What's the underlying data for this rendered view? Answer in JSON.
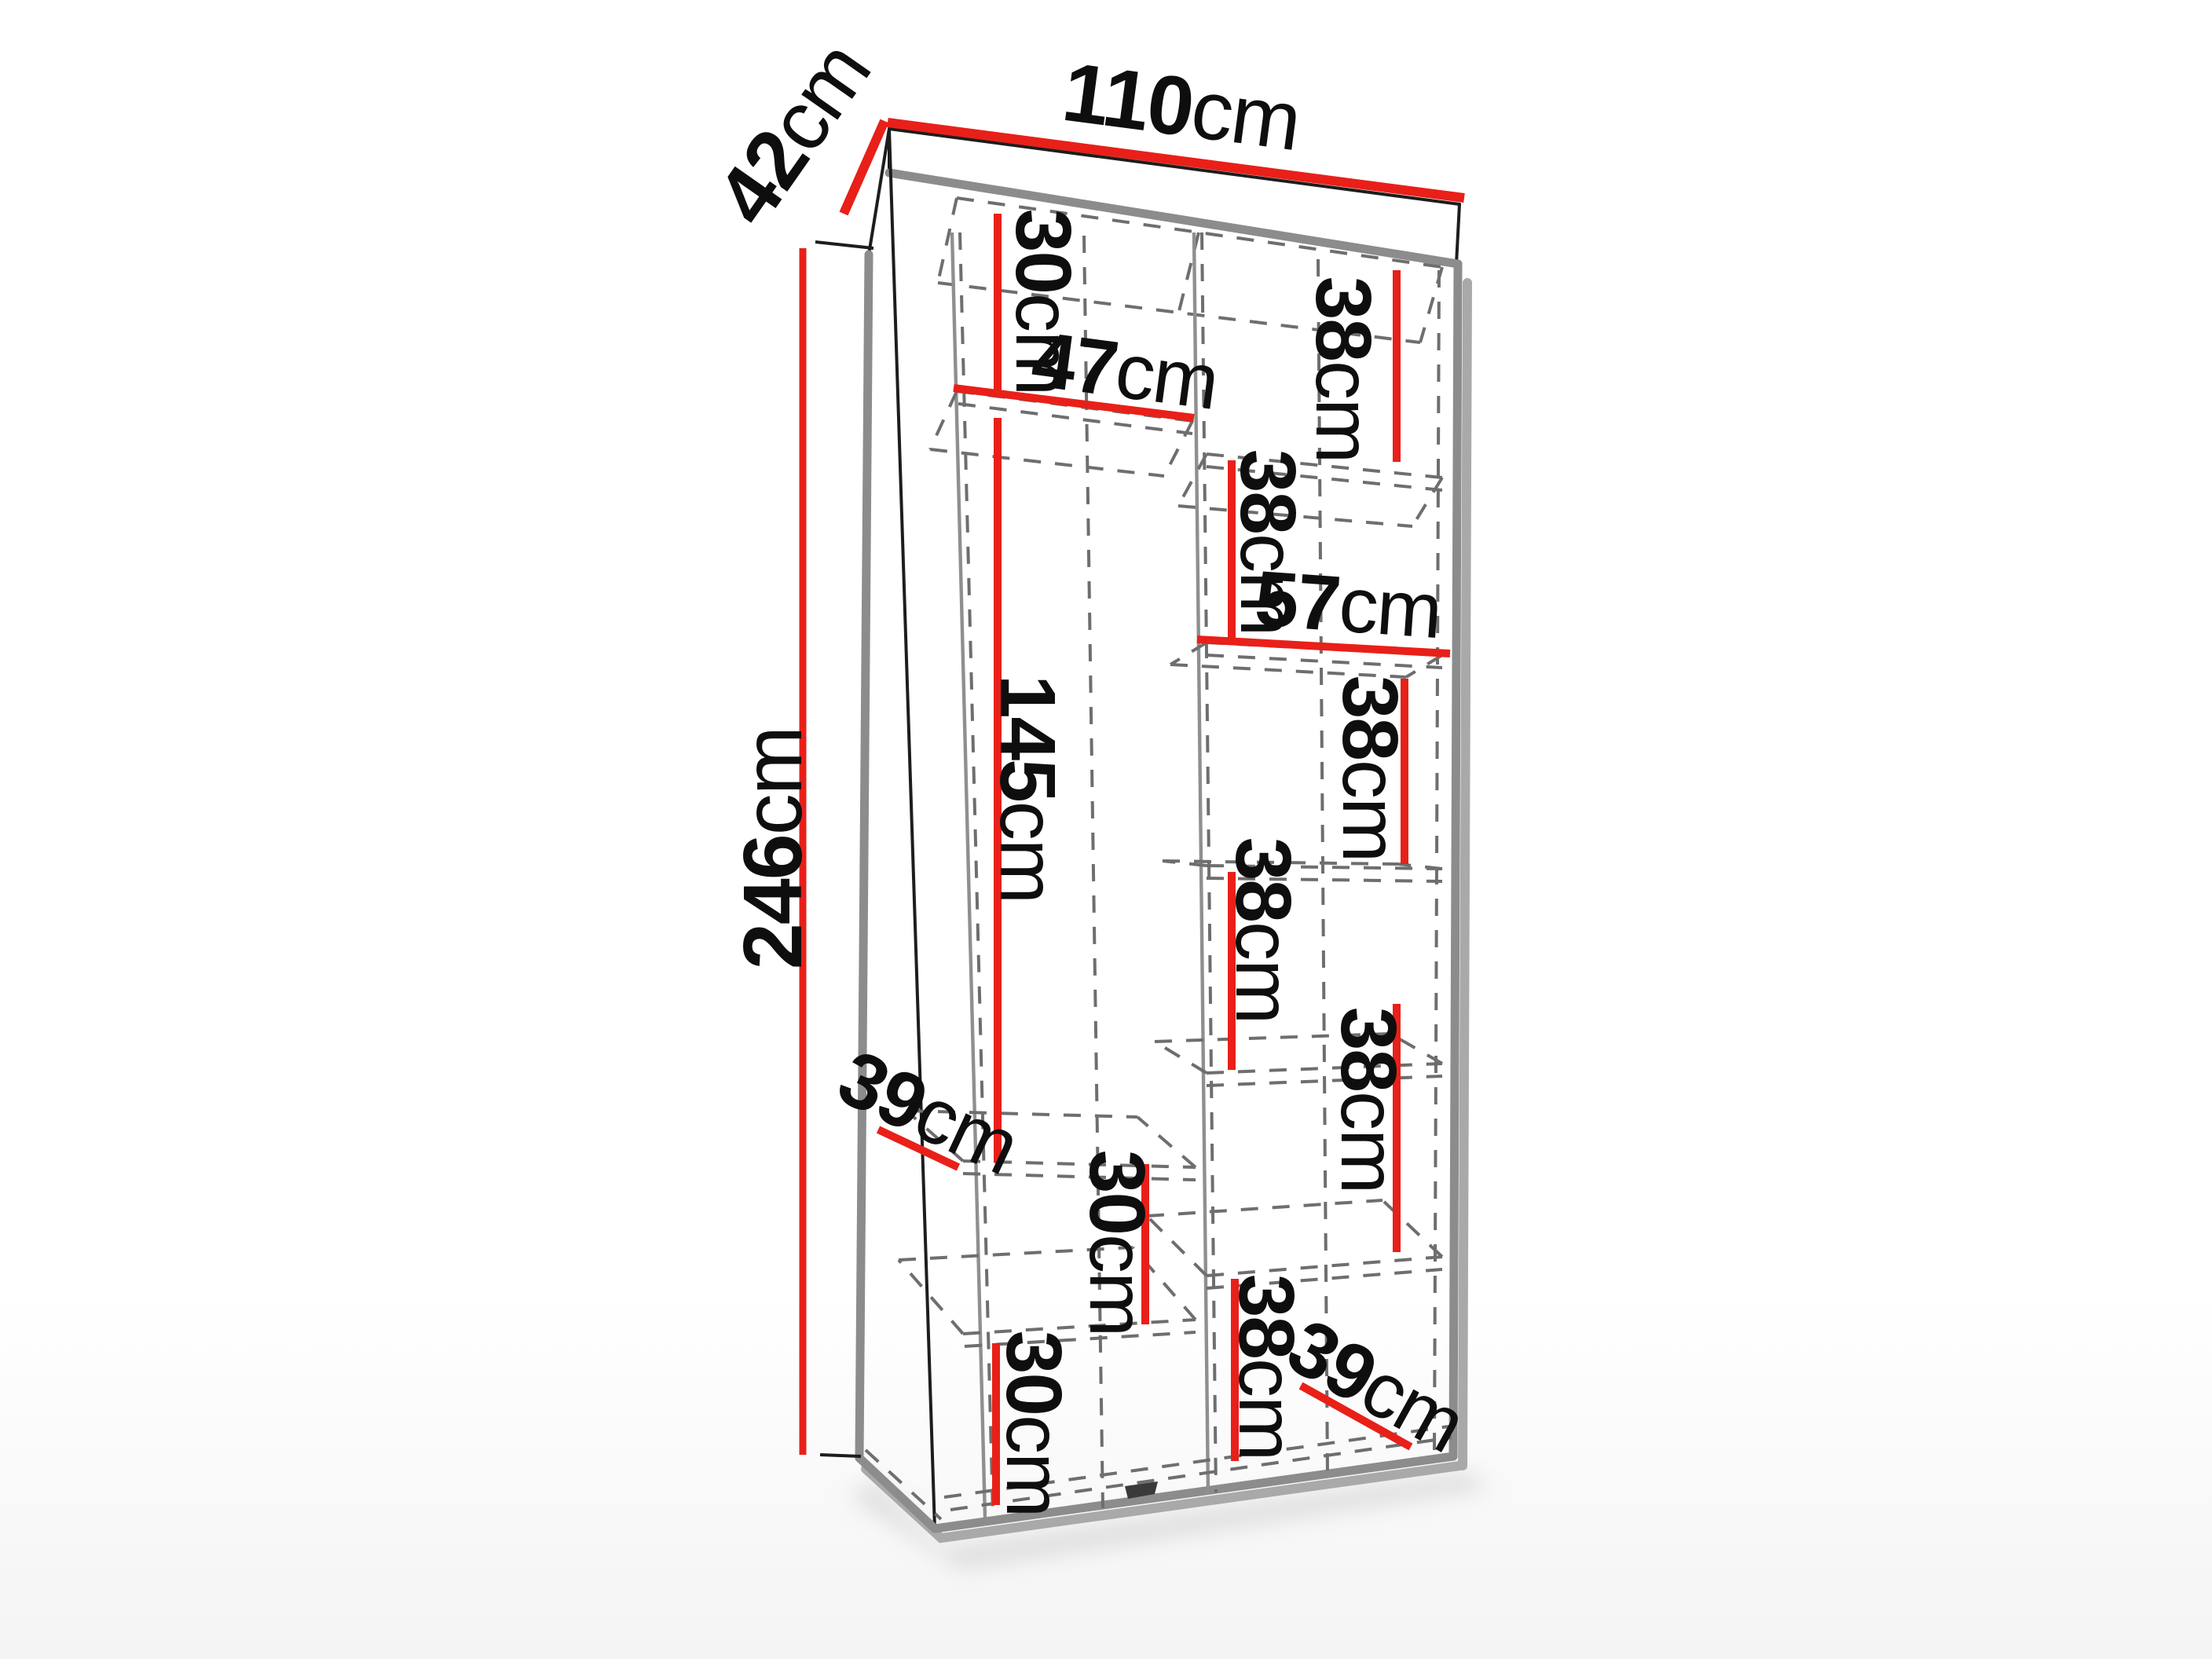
{
  "diagram": {
    "type": "furniture-dimension-diagram",
    "subject": "two-column wardrobe with shelves, pseudo-perspective view",
    "unit": "cm",
    "colors": {
      "dimension_line": "#e82019",
      "visible_edge": "#8c8c8c",
      "outline": "#1d1d1d",
      "hidden_edge": "#6e6e6e",
      "label_text": "#0e0e0e",
      "background": "#ffffff"
    }
  },
  "dims": {
    "width": {
      "v": "110",
      "u": "cm"
    },
    "depth": {
      "v": "42",
      "u": "cm"
    },
    "height": {
      "v": "246",
      "u": "cm"
    },
    "left_top_gap": {
      "v": "30",
      "u": "cm"
    },
    "left_shelf_width": {
      "v": "47",
      "u": "cm"
    },
    "left_tall_gap": {
      "v": "145",
      "u": "cm"
    },
    "left_shelf_depth": {
      "v": "39",
      "u": "cm"
    },
    "left_mid_gap": {
      "v": "30",
      "u": "cm"
    },
    "left_bottom_gap": {
      "v": "30",
      "u": "cm"
    },
    "right_shelf_width": {
      "v": "57",
      "u": "cm"
    },
    "right_shelf_depth": {
      "v": "39",
      "u": "cm"
    },
    "right_gaps": [
      {
        "v": "38",
        "u": "cm"
      },
      {
        "v": "38",
        "u": "cm"
      },
      {
        "v": "38",
        "u": "cm"
      },
      {
        "v": "38",
        "u": "cm"
      },
      {
        "v": "38",
        "u": "cm"
      },
      {
        "v": "38",
        "u": "cm"
      }
    ]
  }
}
